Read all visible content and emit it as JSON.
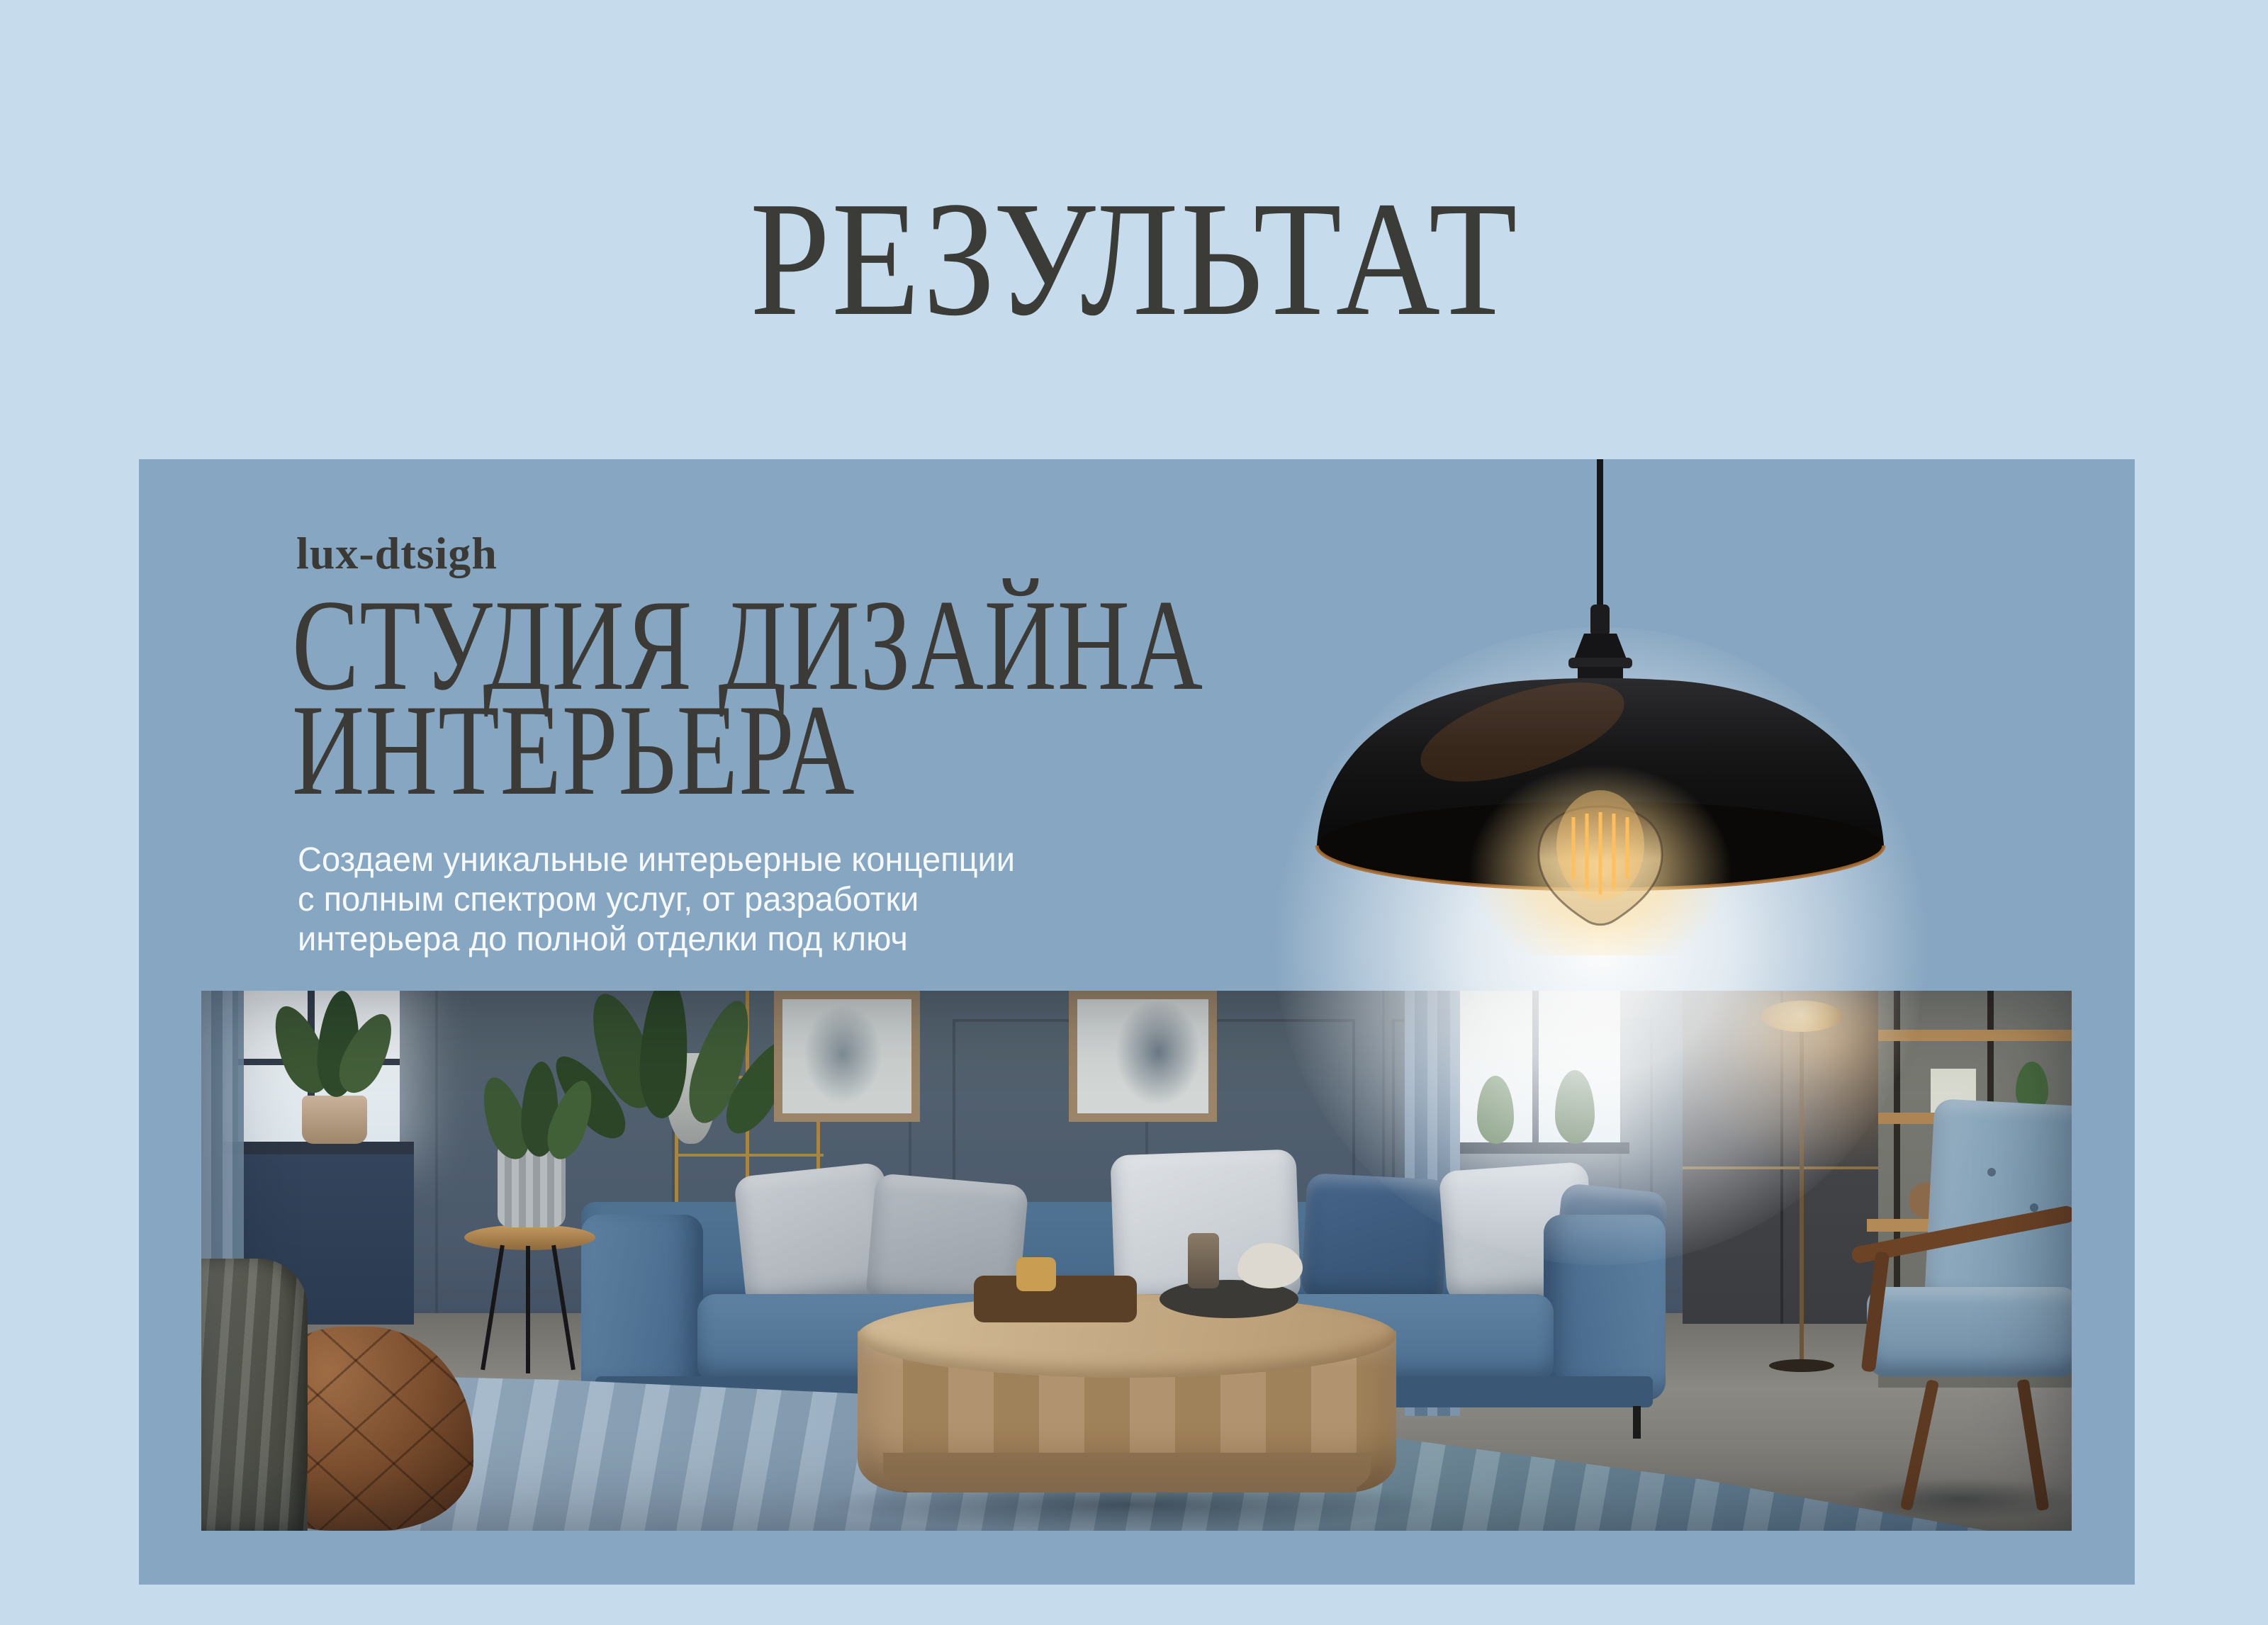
{
  "page": {
    "title": "РЕЗУЛЬТАТ",
    "background_color": "#c6dbec",
    "title_color": "#3b3b38"
  },
  "banner": {
    "background_color": "#87a6c1",
    "brand": "lux-dtsigh",
    "heading": {
      "line1": "СТУДИЯ ДИЗАЙНА",
      "line2": "ИНТЕРЬЕРА"
    },
    "description": {
      "line1": "Создаем уникальные интерьерные концепции",
      "line2": "с полным спектром услуг, от разработки",
      "line3": "интерьера до полной отделки под ключ"
    },
    "heading_color": "#3b3a37",
    "description_color": "#f6f9fb"
  },
  "lamp": {
    "kind": "industrial-pendant-lamp",
    "shade_color": "#141415",
    "rim_color": "#a96b30",
    "filament_color": "#ffb644",
    "glow_color": "#ffffff"
  },
  "photo": {
    "kind": "living-room-interior",
    "wall_color": "#4b5a6c",
    "sofa_color": "#4f7292",
    "rug_color": "#93aabf",
    "floor_color": "#85837e",
    "coffee_table_color": "#b2936f",
    "pouf_color": "#7c4f30"
  }
}
